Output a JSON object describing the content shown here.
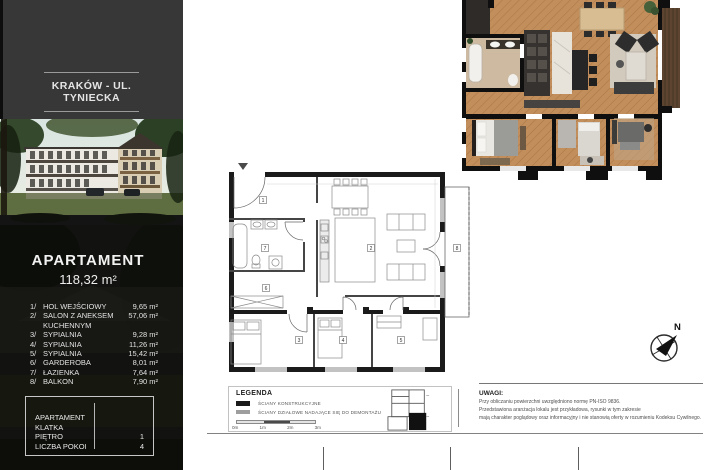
{
  "sidebar": {
    "location_title": "KRAKÓW - UL. TYNIECKA",
    "apartment": {
      "heading": "APARTAMENT",
      "total_area": "118,32 m²",
      "rooms": [
        {
          "no": "1/",
          "name": "HOL WEJŚCIOWY",
          "area": "9,65 m²"
        },
        {
          "no": "2/",
          "name": "SALON Z ANEKSEM KUCHENNYM",
          "area": "57,06 m²"
        },
        {
          "no": "3/",
          "name": "SYPIALNIA",
          "area": "9,28 m²"
        },
        {
          "no": "4/",
          "name": "SYPIALNIA",
          "area": "11,26 m²"
        },
        {
          "no": "5/",
          "name": "SYPIALNIA",
          "area": "15,42 m²"
        },
        {
          "no": "6/",
          "name": "GARDEROBA",
          "area": "8,01 m²"
        },
        {
          "no": "7/",
          "name": "ŁAZIENKA",
          "area": "7,64 m²"
        },
        {
          "no": "8/",
          "name": "BALKON",
          "area": "7,90 m²"
        }
      ]
    },
    "info_box": {
      "rows": [
        {
          "label": "APARTAMENT",
          "value": ""
        },
        {
          "label": "KLATKA",
          "value": ""
        },
        {
          "label": "PIĘTRO",
          "value": "1"
        },
        {
          "label": "LICZBA POKOI",
          "value": "4"
        }
      ]
    }
  },
  "floorplan": {
    "room_numbers": [
      "1",
      "2",
      "3",
      "4",
      "5",
      "6",
      "7",
      "8"
    ]
  },
  "legend": {
    "title": "LEGENDA",
    "items": [
      {
        "label": "ŚCIANY KONSTRUKCYJNE"
      },
      {
        "label": "ŚCIANY DZIAŁOWE NADAJĄCE SIĘ DO DEMONTAŻU"
      }
    ],
    "scale_labels": [
      "0m",
      "1m",
      "2m",
      "3m"
    ]
  },
  "notes": {
    "title": "UWAGI:",
    "lines": [
      "Przy obliczaniu powierzchni uwzględniono normę PN-ISO 9836.",
      "Przedstawiona aranżacja lokalu jest przykładowa, rysunki w tym zakresie",
      "mają charakter poglądowy oraz informacyjny i nie stanowią oferty w rozumieniu Kodeksu Cywilnego."
    ]
  },
  "compass": {
    "label": "N"
  },
  "colors": {
    "sidebar_top": "#373737",
    "sidebar_dark": "#121210",
    "wall_structural": "#1b1b1b",
    "wall_partition": "#9e9e9e",
    "wood_floor": "#c28e5c"
  }
}
